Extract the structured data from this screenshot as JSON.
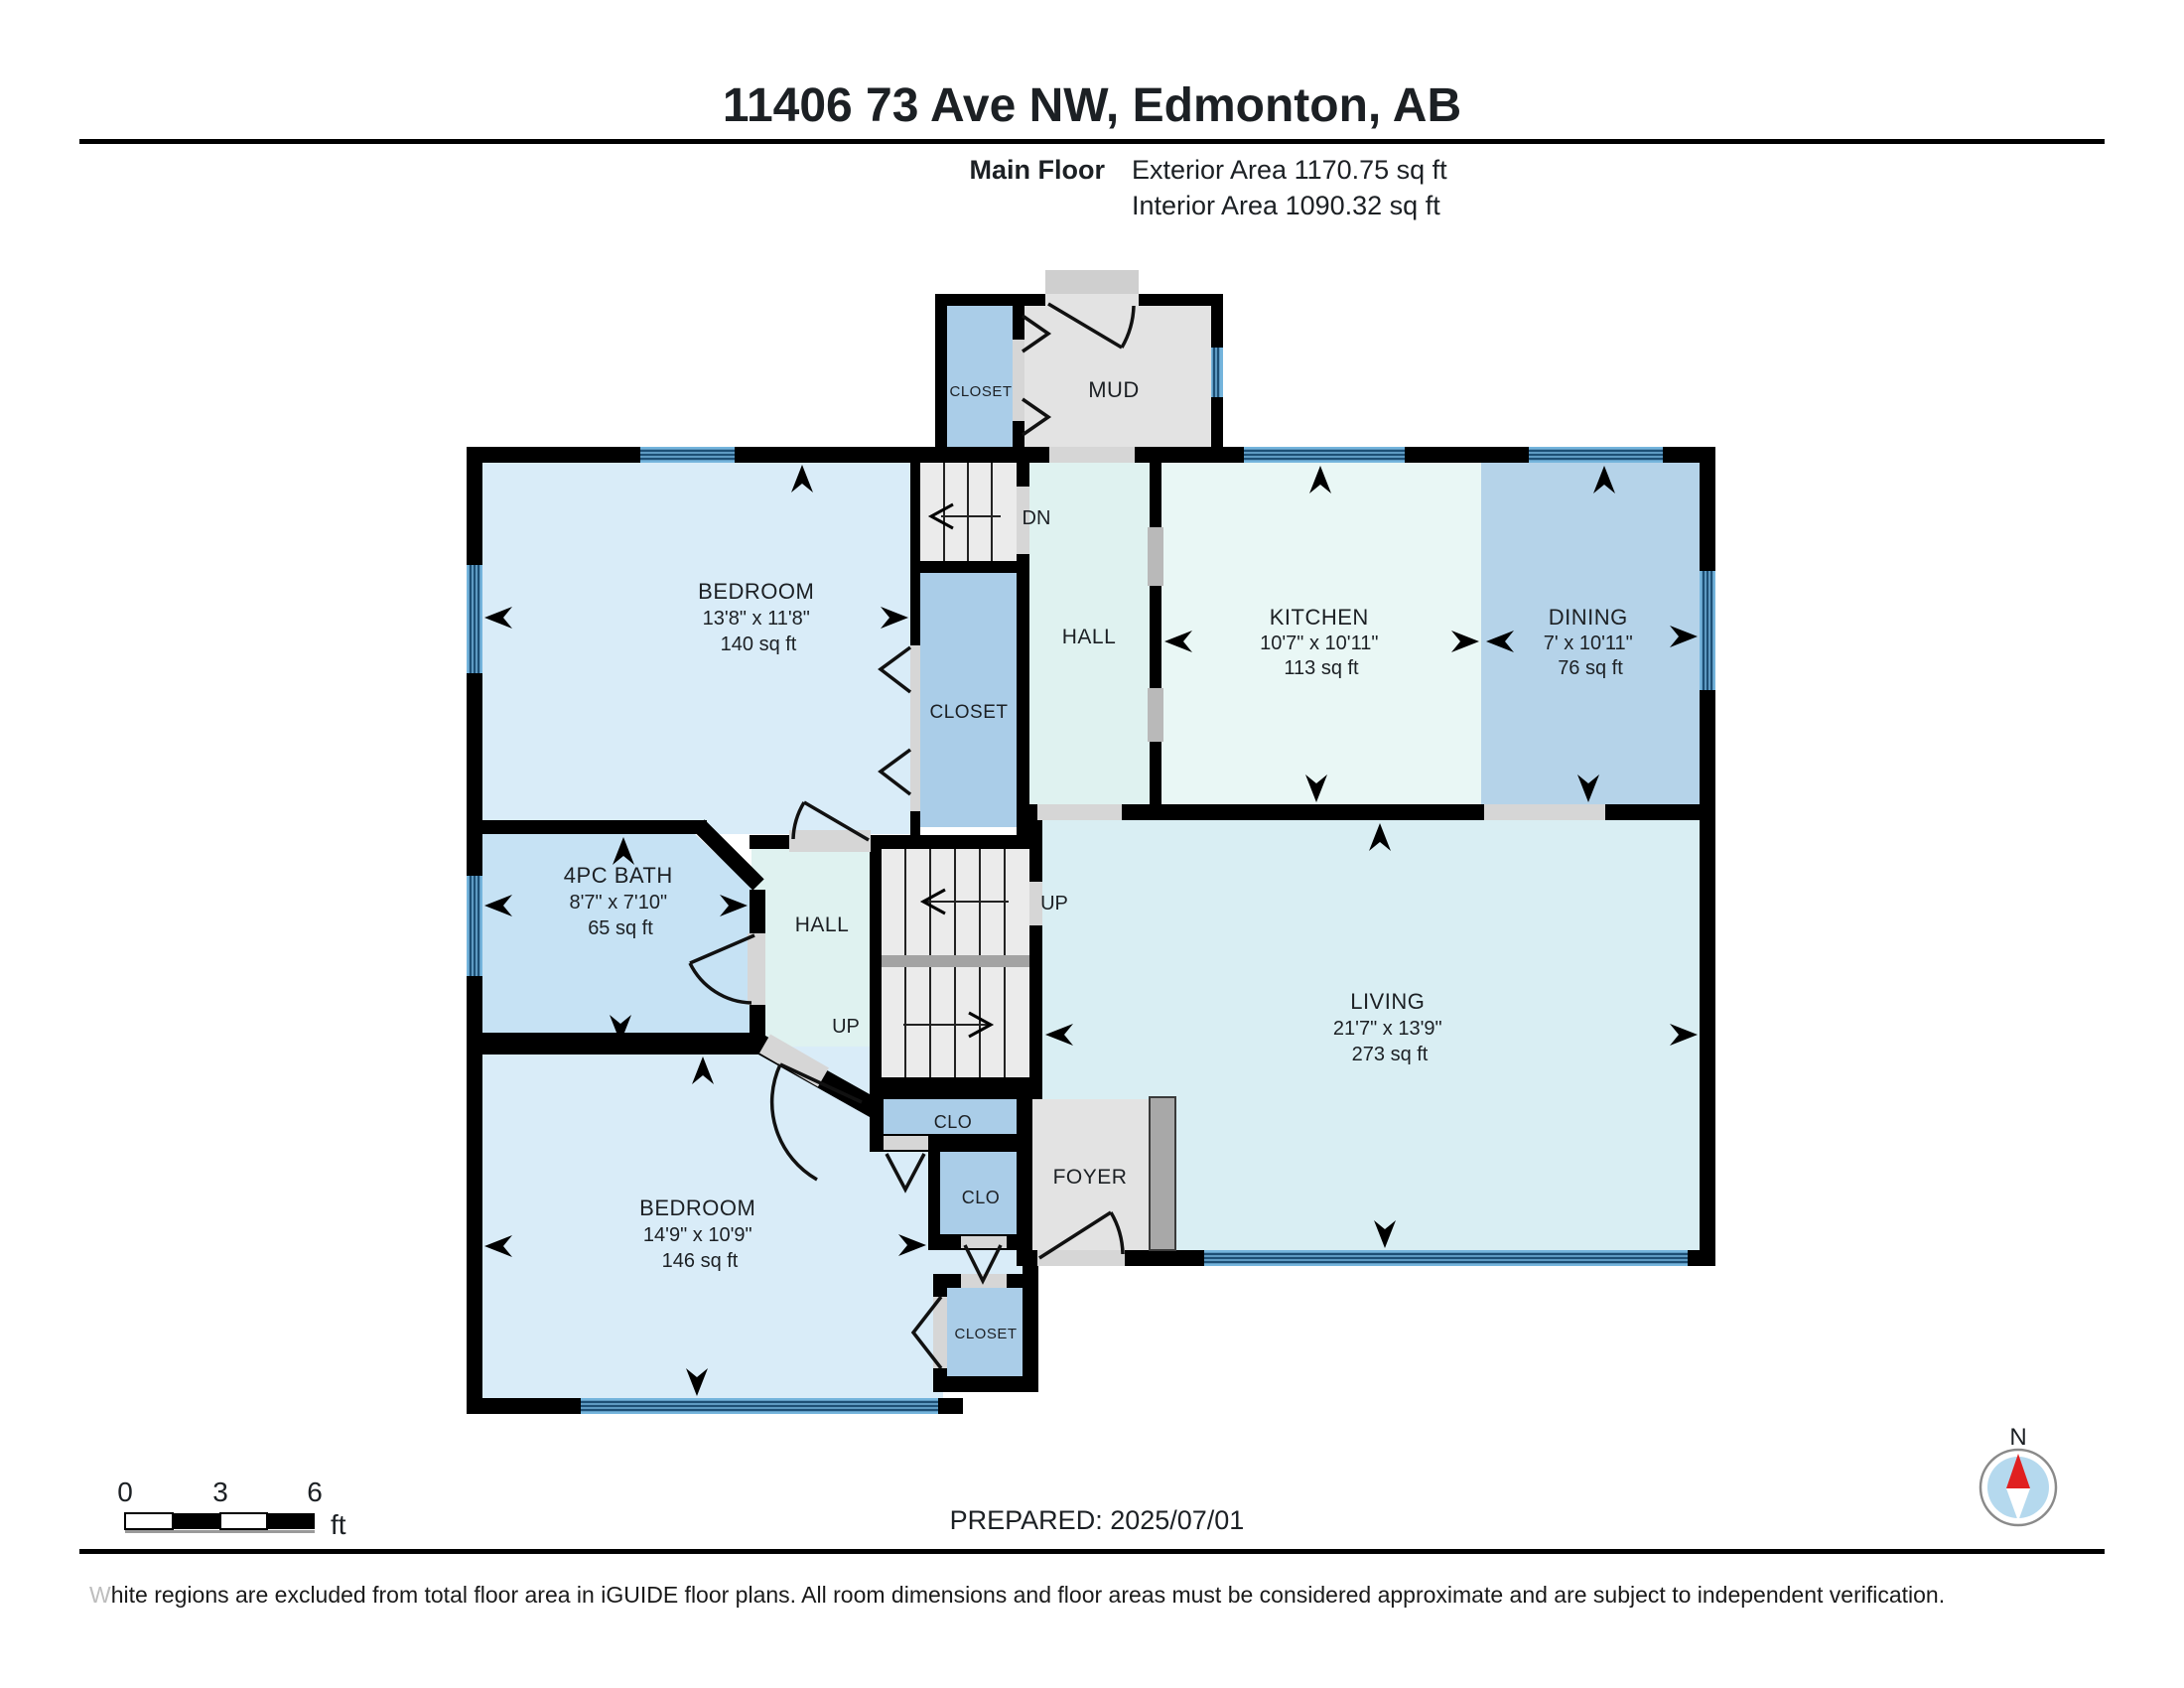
{
  "header": {
    "title": "11406 73 Ave NW, Edmonton, AB",
    "floor_label": "Main Floor",
    "exterior_area": "Exterior Area 1170.75 sq ft",
    "interior_area": "Interior Area 1090.32 sq ft"
  },
  "rooms": {
    "mud": {
      "name": "MUD"
    },
    "mud_closet": {
      "name": "CLOSET"
    },
    "bedroom1": {
      "name": "BEDROOM",
      "dims": "13'8\" x 11'8\"",
      "area": "140 sq ft"
    },
    "hall_upper": {
      "name": "HALL"
    },
    "kitchen": {
      "name": "KITCHEN",
      "dims": "10'7\" x 10'11\"",
      "area": "113 sq ft"
    },
    "dining": {
      "name": "DINING",
      "dims": "7' x 10'11\"",
      "area": "76 sq ft"
    },
    "hall_closet": {
      "name": "CLOSET"
    },
    "bath": {
      "name": "4PC BATH",
      "dims": "8'7\" x 7'10\"",
      "area": "65 sq ft"
    },
    "hall_lower": {
      "name": "HALL"
    },
    "living": {
      "name": "LIVING",
      "dims": "21'7\" x 13'9\"",
      "area": "273 sq ft"
    },
    "bedroom2": {
      "name": "BEDROOM",
      "dims": "14'9\" x 10'9\"",
      "area": "146 sq ft"
    },
    "clo1": {
      "name": "CLO"
    },
    "clo2": {
      "name": "CLO"
    },
    "bedroom2_closet": {
      "name": "CLOSET"
    },
    "foyer": {
      "name": "FOYER"
    }
  },
  "stairs": {
    "down": "DN",
    "up_upper": "UP",
    "up_lower": "UP"
  },
  "scale_bar": {
    "tick0": "0",
    "tick3": "3",
    "tick6": "6",
    "unit": "ft"
  },
  "compass": {
    "north": "N"
  },
  "footer": {
    "prepared": "PREPARED: 2025/07/01",
    "disclaimer_lead": "W",
    "disclaimer_rest": "hite regions are excluded from total floor area in iGUIDE floor plans. All room dimensions and floor areas must be considered approximate and are subject to independent verification."
  },
  "colors": {
    "bedroom": "#d9ecf8",
    "bath": "#c6e2f4",
    "dining": "#b5d3e9",
    "kitchen": "#e9f7f5",
    "hall": "#dff2f0",
    "living": "#d9eef3",
    "closet": "#aacde8",
    "mud_foyer": "#e3e3e3",
    "window": "#74b4dc",
    "wall": "#000000",
    "compass_red": "#e02020"
  }
}
